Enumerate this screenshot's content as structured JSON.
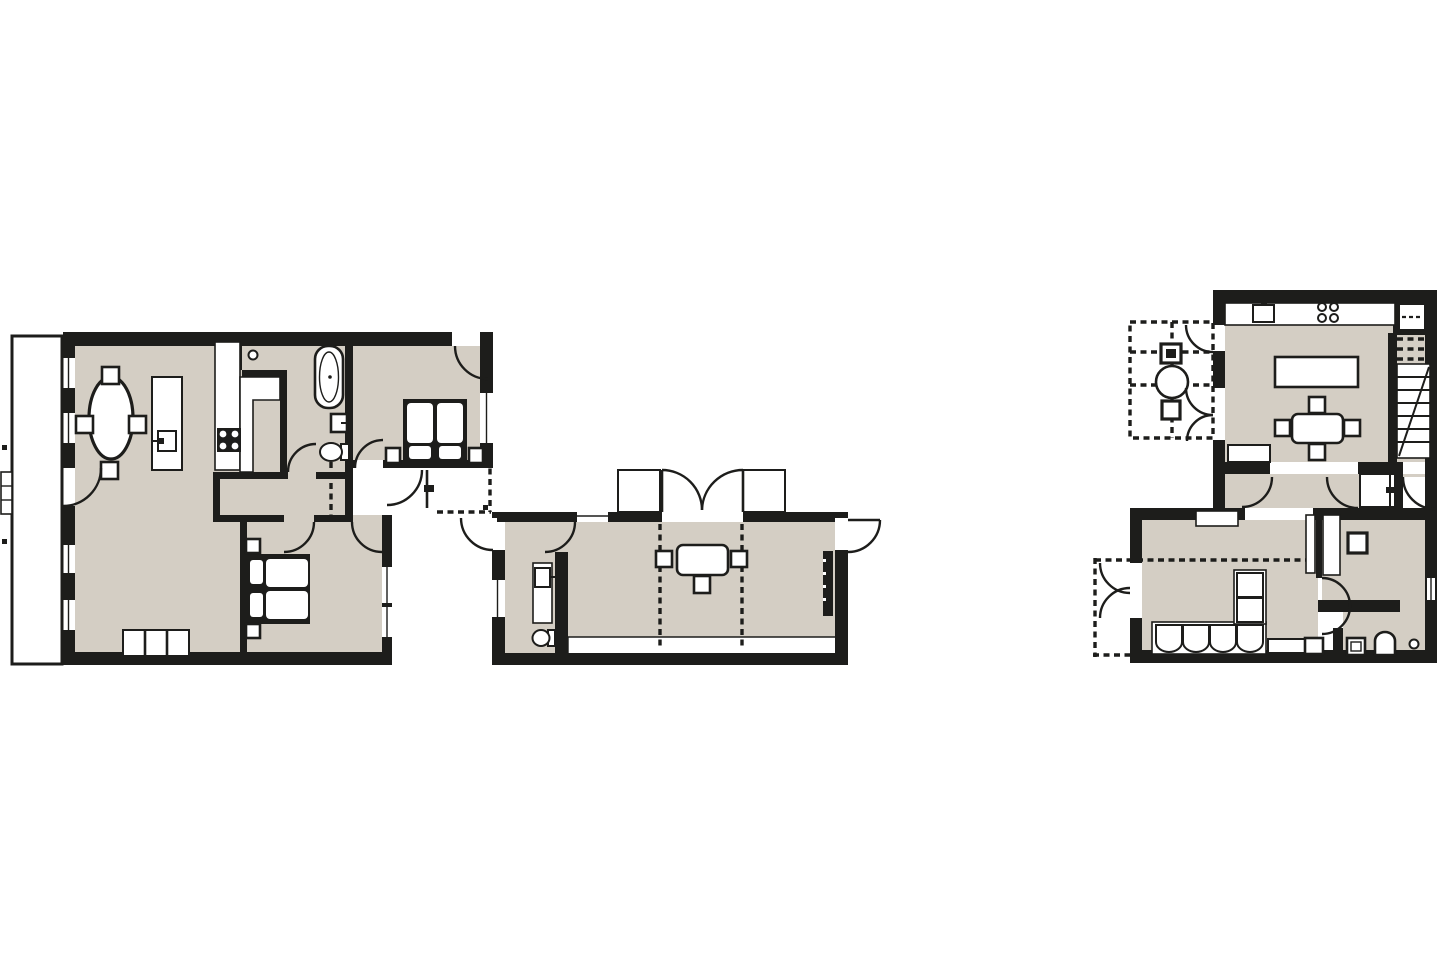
{
  "document": {
    "kind": "architectural-floor-plan-sheet",
    "sheet_count": 3,
    "background": "#ffffff"
  },
  "colors": {
    "wall": "#1d1d1b",
    "floor": "#d4cec4",
    "paper": "#ffffff"
  },
  "plans": [
    {
      "id": "left-apartment",
      "rooms": [
        "living-room",
        "dining-area",
        "kitchen",
        "bathroom",
        "wc",
        "bedroom-top",
        "bedroom-bottom",
        "hall",
        "balcony-strip",
        "entry-porch"
      ],
      "fixtures": [
        "oval-dining-table",
        "four-chairs",
        "kitchen-island-with-sink",
        "range-4-burner",
        "galley-counter",
        "bathtub",
        "washbasin",
        "toilet",
        "double-bed-top",
        "double-bed-bottom",
        "nightstands",
        "sofa-3-seat",
        "balcony-ladder"
      ]
    },
    {
      "id": "middle-pavilion",
      "rooms": [
        "main-room",
        "shower-room",
        "entry"
      ],
      "fixtures": [
        "french-double-doors",
        "side-terrace-slabs",
        "table-with-three-chairs",
        "vanity-with-sink",
        "toilet",
        "radiator",
        "floor-step-band",
        "ceiling-beam-dashed-lines"
      ]
    },
    {
      "id": "right-house",
      "rooms": [
        "kitchen-dining",
        "pergola",
        "pantry-shelves",
        "staircase",
        "chimney-closet",
        "corridor",
        "living-room",
        "bedroom",
        "bathroom",
        "terrace-dashed"
      ],
      "fixtures": [
        "counter-with-sink",
        "range-4-burner",
        "kitchen-island",
        "dining-table-four-chairs",
        "bench",
        "stairs-with-diagonal",
        "pergola-square-units",
        "pergola-circle",
        "corner-sofa",
        "tv-bench",
        "pocket-door-panels",
        "wall-pass-square",
        "toilet",
        "washbasin",
        "floor-drain-circle",
        "wall-niche"
      ]
    }
  ]
}
